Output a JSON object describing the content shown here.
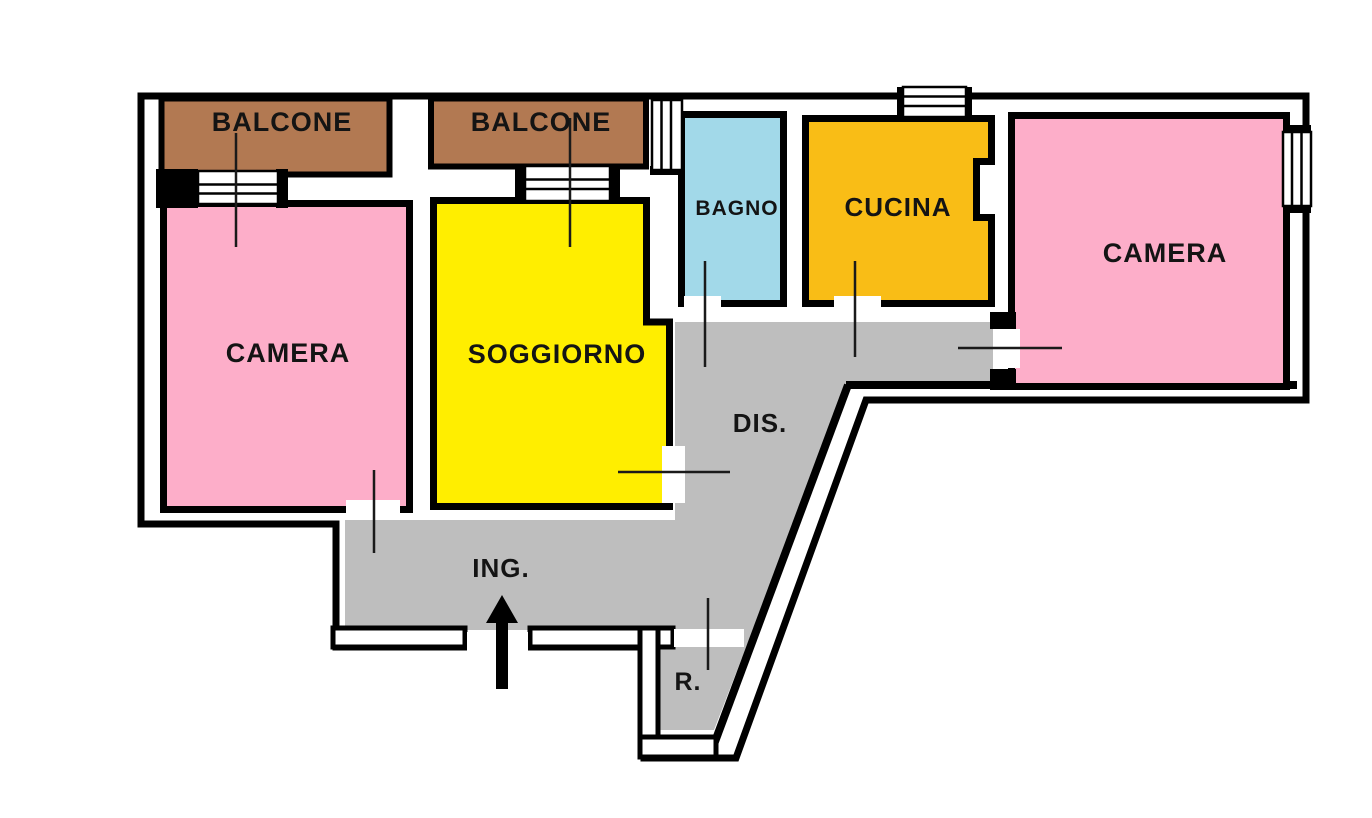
{
  "diagram_type": "apartment floor plan",
  "language": "Italian",
  "colors": {
    "background": "#ffffff",
    "wall": "#000000",
    "floor_gray": "#bebebe"
  },
  "rooms": {
    "balcony_left": {
      "label": "BALCONE",
      "color": "#b27952"
    },
    "balcony_center": {
      "label": "BALCONE",
      "color": "#b27952"
    },
    "bedroom_left": {
      "label": "CAMERA",
      "color": "#fdaec9"
    },
    "living_room": {
      "label": "SOGGIORNO",
      "color": "#ffee00"
    },
    "bathroom": {
      "label": "BAGNO",
      "color": "#a2d9e9"
    },
    "kitchen": {
      "label": "CUCINA",
      "color": "#f9bd16"
    },
    "bedroom_right": {
      "label": "CAMERA",
      "color": "#fdaec9"
    },
    "hallway": {
      "label": "DIS.",
      "color": "#bebebe"
    },
    "entry": {
      "label": "ING.",
      "color": "#bebebe"
    },
    "storage": {
      "label": "R.",
      "color": "#bebebe"
    }
  }
}
